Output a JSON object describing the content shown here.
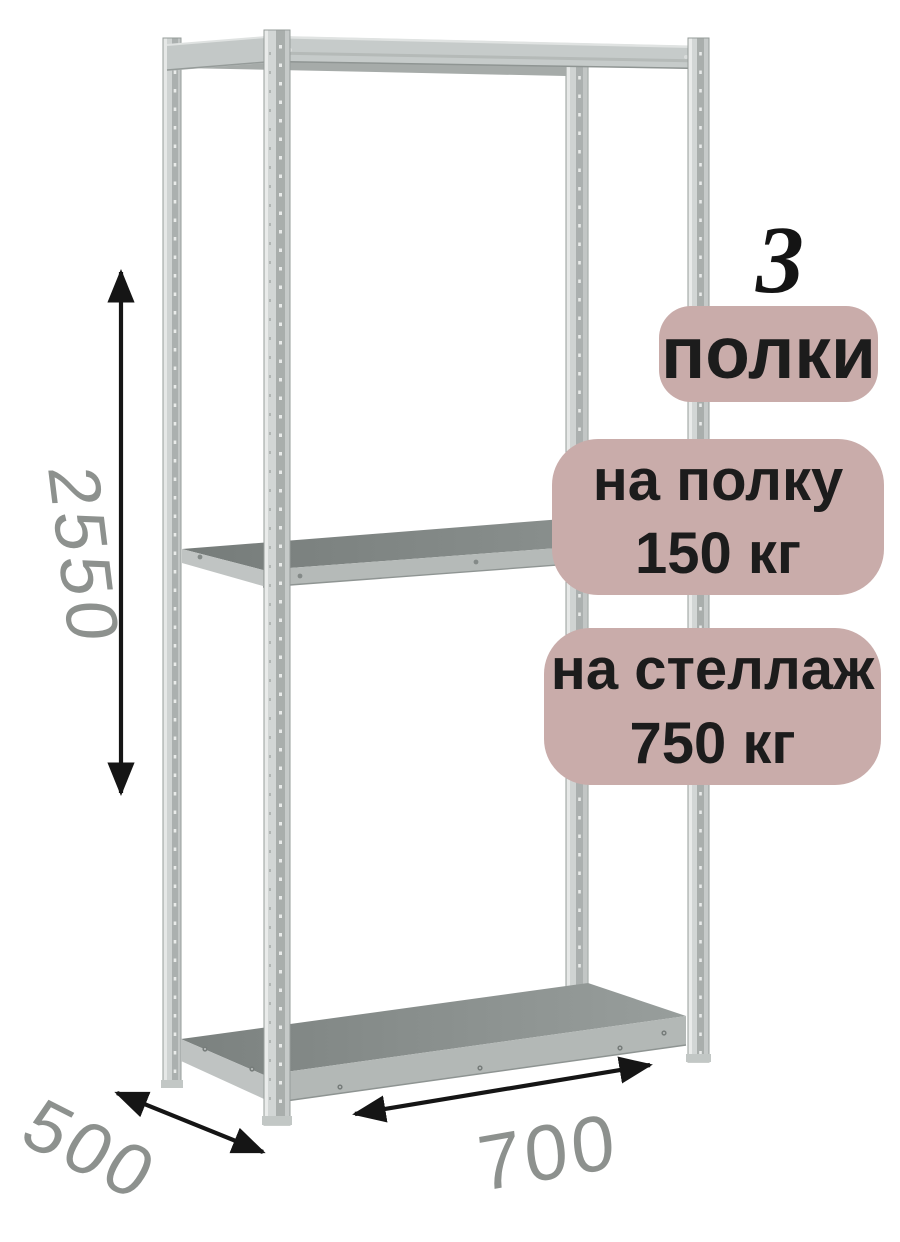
{
  "product_image": {
    "shelves_badge": {
      "count": "3",
      "label": "полки"
    },
    "shelf_load_badge": {
      "line1": "на полку",
      "line2": "150 кг"
    },
    "rack_load_badge": {
      "line1": "на стеллаж",
      "line2": "750 кг"
    }
  },
  "dimensions": {
    "height": "2550",
    "depth": "500",
    "width": "700"
  },
  "icons": {
    "height_arrow": "double-headed-vertical-arrow",
    "depth_arrow": "double-headed-diagonal-arrow",
    "width_arrow": "double-headed-horizontal-arrow"
  },
  "colors": {
    "background": "#ffffff",
    "badge_background": "#c9acaa",
    "badge_text": "#1c1c1c",
    "dimension_label": "#8d918e",
    "arrow": "#151515",
    "rack_metal_light": "#d2d6d5",
    "rack_metal_mid": "#c3c8c7",
    "rack_metal_dark": "#a9aeac",
    "shelf_surface": "#828886",
    "shelf_edge": "#b5bab8"
  }
}
